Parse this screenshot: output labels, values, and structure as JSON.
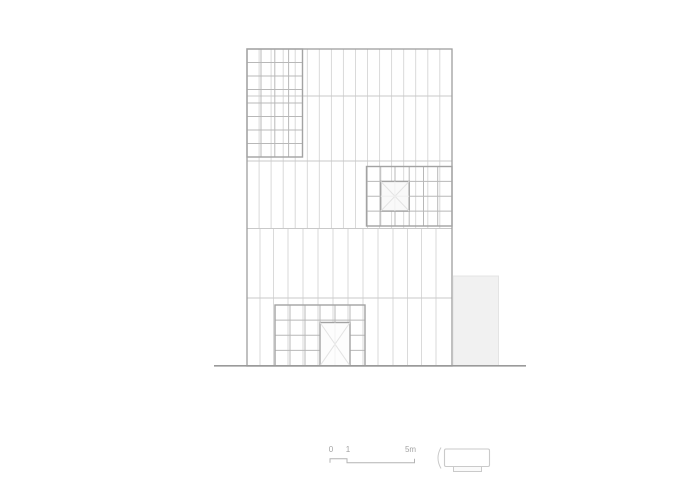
{
  "canvas": {
    "width": 700,
    "height": 500,
    "background": "#ffffff"
  },
  "drawing": {
    "kind": "architectural-front-elevation",
    "colors": {
      "outline": "#9e9e9e",
      "panel": "#d6d6d6",
      "floor": "#c9c9c9",
      "gridline": "#b8b8b8",
      "gridborder": "#a3a3a3",
      "xline": "#e3e3e3",
      "faint": "#efefef",
      "paneFill": "#f9f9f9",
      "doorFill": "#fdfdfd",
      "ground": "#9a9a9a",
      "annexFill": "#f1f1f1",
      "annexStroke": "#e4e4e4",
      "scaleLine": "#b4b4b4",
      "scaleText": "#a3a3a3",
      "iconLine": "#cacaca",
      "white": "#ffffff",
      "iconBaseFill": "#fafafa"
    },
    "layers": [
      {
        "name": "building-facade",
        "elements": [
          {
            "t": "vlines",
            "name": "panel-line-upper",
            "xs": [
              259.1,
              271.1,
              283.2,
              295.2,
              307.3,
              319.3,
              331.4,
              343.4,
              355.5,
              367.5,
              379.6,
              391.6,
              403.7,
              415.7,
              427.8,
              439.8
            ],
            "y1": 49,
            "y2": 228.5,
            "c": "panel",
            "w": 0.9
          },
          {
            "t": "vlines",
            "name": "panel-line-lower",
            "xs": [
              260,
              273.5,
              288,
              303,
              318,
              333,
              348,
              363,
              378,
              393,
              407.5,
              421.5,
              436
            ],
            "y1": 228.5,
            "y2": 365.8,
            "c": "panel",
            "w": 0.9
          },
          {
            "t": "hlines",
            "name": "floor-line",
            "ys": [
              96,
              161,
              228.5,
              298
            ],
            "x1": 247,
            "x2": 452,
            "c": "floor",
            "w": 0.9
          },
          {
            "t": "rect",
            "name": "building-outline",
            "x": 247,
            "y": 49,
            "wd": 205,
            "h": 317,
            "f": "none",
            "c": "outline",
            "w": 1.3
          }
        ]
      },
      {
        "name": "window-grid-top-left",
        "elements": [
          {
            "t": "vlines",
            "name": "grid-column-line",
            "xs": [
              261,
              274.8,
              288.6
            ],
            "y1": 49,
            "y2": 157,
            "c": "gridline",
            "w": 1
          },
          {
            "t": "hlines",
            "name": "grid-row-line",
            "ys": [
              62.5,
              76,
              89.5,
              103,
              116.5,
              130,
              143.5
            ],
            "x1": 247,
            "x2": 302.5,
            "c": "gridline",
            "w": 1
          },
          {
            "t": "rect",
            "name": "grid-border",
            "x": 247,
            "y": 49,
            "wd": 55.5,
            "h": 108,
            "f": "none",
            "c": "gridborder",
            "w": 1.4
          }
        ]
      },
      {
        "name": "window-grid-middle-right",
        "elements": [
          {
            "t": "vlines",
            "name": "grid-column-line",
            "xs": [
              380.7,
              395,
              409.2,
              423.5,
              437.7
            ],
            "y1": 166.5,
            "y2": 226,
            "c": "gridline",
            "w": 1
          },
          {
            "t": "hlines",
            "name": "grid-row-line",
            "ys": [
              181.4,
              196.3,
              211.1
            ],
            "x1": 366.5,
            "x2": 452,
            "c": "gridline",
            "w": 1
          },
          {
            "t": "rect",
            "name": "grid-border",
            "x": 366.5,
            "y": 166.5,
            "wd": 85.5,
            "h": 59.5,
            "f": "none",
            "c": "gridborder",
            "w": 1.4
          },
          {
            "t": "rect",
            "name": "x-pane",
            "x": 380.7,
            "y": 181.4,
            "wd": 28.5,
            "h": 29.7,
            "f": "paneFill",
            "c": "gridborder",
            "w": 1.4
          },
          {
            "t": "path",
            "name": "x-pane-diagonals",
            "d": "M380.7,181.4 L409.2,211.1 M409.2,181.4 L380.7,211.1",
            "c": "xline",
            "w": 1
          },
          {
            "t": "path",
            "name": "x-pane-cross",
            "d": "M394.9,181.4 L394.9,211.1 M380.7,196.2 L409.2,196.2",
            "c": "faint",
            "w": 0.8
          }
        ]
      },
      {
        "name": "entrance-grid",
        "elements": [
          {
            "t": "vlines",
            "name": "grid-column-line",
            "xs": [
              290,
              305,
              320,
              335,
              350
            ],
            "y1": 305,
            "y2": 365.8,
            "c": "gridline",
            "w": 1
          },
          {
            "t": "hlines",
            "name": "grid-row-line",
            "ys": [
              320.1,
              335.2,
              350.4
            ],
            "x1": 275,
            "x2": 365,
            "c": "gridline",
            "w": 1
          },
          {
            "t": "rect",
            "name": "grid-border",
            "x": 275,
            "y": 305,
            "wd": 90,
            "h": 60.8,
            "f": "none",
            "c": "gridborder",
            "w": 1.4
          },
          {
            "t": "rect",
            "name": "entrance-door",
            "x": 320,
            "y": 322.5,
            "wd": 30,
            "h": 43.3,
            "f": "doorFill",
            "c": "gridborder",
            "w": 1.4
          },
          {
            "t": "path",
            "name": "door-diagonals",
            "d": "M320,322.5 L350,365.8 M350,322.5 L320,365.8",
            "c": "xline",
            "w": 1
          },
          {
            "t": "path",
            "name": "door-center-line",
            "d": "M335,322.5 L335,365.8",
            "c": "faint",
            "w": 0.8
          }
        ]
      },
      {
        "name": "annex-building",
        "elements": [
          {
            "t": "rect",
            "name": "annex-volume",
            "x": 453,
            "y": 276,
            "wd": 45.5,
            "h": 89.8,
            "f": "annexFill",
            "c": "annexStroke",
            "w": 1
          }
        ]
      },
      {
        "name": "ground",
        "elements": [
          {
            "t": "line",
            "name": "ground-line",
            "x1": 214,
            "y1": 365.8,
            "x2": 526,
            "y2": 365.8,
            "c": "ground",
            "w": 1.6
          }
        ]
      },
      {
        "name": "scale-bar",
        "elements": [
          {
            "t": "polyline",
            "name": "scale-bar-profile",
            "pts": "330,462.8 330,458.8 347,458.8 347,462.8 414.5,462.8 414.5,458.8",
            "c": "scaleLine",
            "w": 1
          },
          {
            "t": "text",
            "name": "scale-label-zero",
            "x": 331,
            "y": 452,
            "text": "0",
            "size": 8,
            "anchor": "middle",
            "c": "scaleText"
          },
          {
            "t": "text",
            "name": "scale-label-one",
            "x": 348,
            "y": 452,
            "text": "1",
            "size": 8,
            "anchor": "middle",
            "c": "scaleText"
          },
          {
            "t": "text",
            "name": "scale-label-five-m",
            "x": 410.5,
            "y": 452,
            "text": "5m",
            "size": 8,
            "anchor": "middle",
            "c": "scaleText"
          }
        ]
      },
      {
        "name": "legend-icon",
        "elements": [
          {
            "t": "path",
            "name": "bracket-icon",
            "d": "M441,447.5 Q435,458 441,468.5",
            "c": "iconLine",
            "w": 1,
            "f": "none"
          },
          {
            "t": "rect",
            "name": "building-side-icon-body",
            "x": 444.5,
            "y": 449,
            "wd": 45,
            "h": 17.5,
            "rx": 1.5,
            "f": "white",
            "c": "iconLine",
            "w": 1.1
          },
          {
            "t": "rect",
            "name": "building-side-icon-base",
            "x": 453.5,
            "y": 466.5,
            "wd": 28,
            "h": 5,
            "f": "iconBaseFill",
            "c": "iconLine",
            "w": 1
          }
        ]
      }
    ]
  }
}
